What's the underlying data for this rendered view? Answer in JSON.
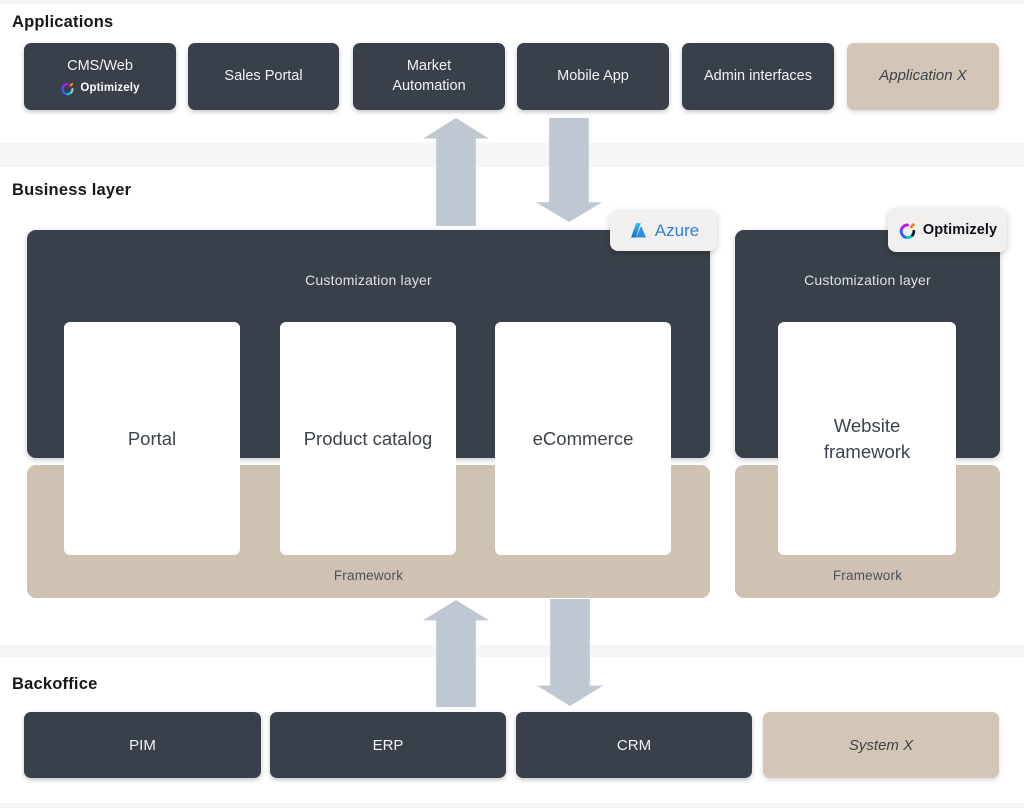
{
  "sections": {
    "applications": {
      "title": "Applications",
      "boxes": [
        {
          "label": "CMS/Web",
          "logo_text": "Optimizely"
        },
        {
          "label": "Sales Portal"
        },
        {
          "label": "Market Automation"
        },
        {
          "label": "Mobile App"
        },
        {
          "label": "Admin interfaces"
        },
        {
          "label": "Application X"
        }
      ]
    },
    "business": {
      "title": "Business layer",
      "azure_stack": {
        "badge_text": "Azure",
        "customization_label": "Customization layer",
        "cards": [
          {
            "label": "Portal"
          },
          {
            "label": "Product catalog"
          },
          {
            "label": "eCommerce"
          }
        ],
        "framework_label": "Framework"
      },
      "optimizely_stack": {
        "badge_text": "Optimizely",
        "customization_label": "Customization layer",
        "cards": [
          {
            "label": "Website framework"
          }
        ],
        "framework_label": "Framework"
      }
    },
    "backoffice": {
      "title": "Backoffice",
      "boxes": [
        {
          "label": "PIM"
        },
        {
          "label": "ERP"
        },
        {
          "label": "CRM"
        },
        {
          "label": "System X"
        }
      ]
    }
  },
  "colors": {
    "dark_slate": "#394049",
    "beige_box": "#d3c6b7",
    "framework_beige": "#cfc2b3",
    "arrow_gray_blue": "#bfc7d2",
    "badge_background": "#f1f0ee",
    "azure_blue": "#2e83d9",
    "card_text": "#3c434d",
    "section_background": "#ffffff",
    "page_band": "#f5f5f6"
  }
}
